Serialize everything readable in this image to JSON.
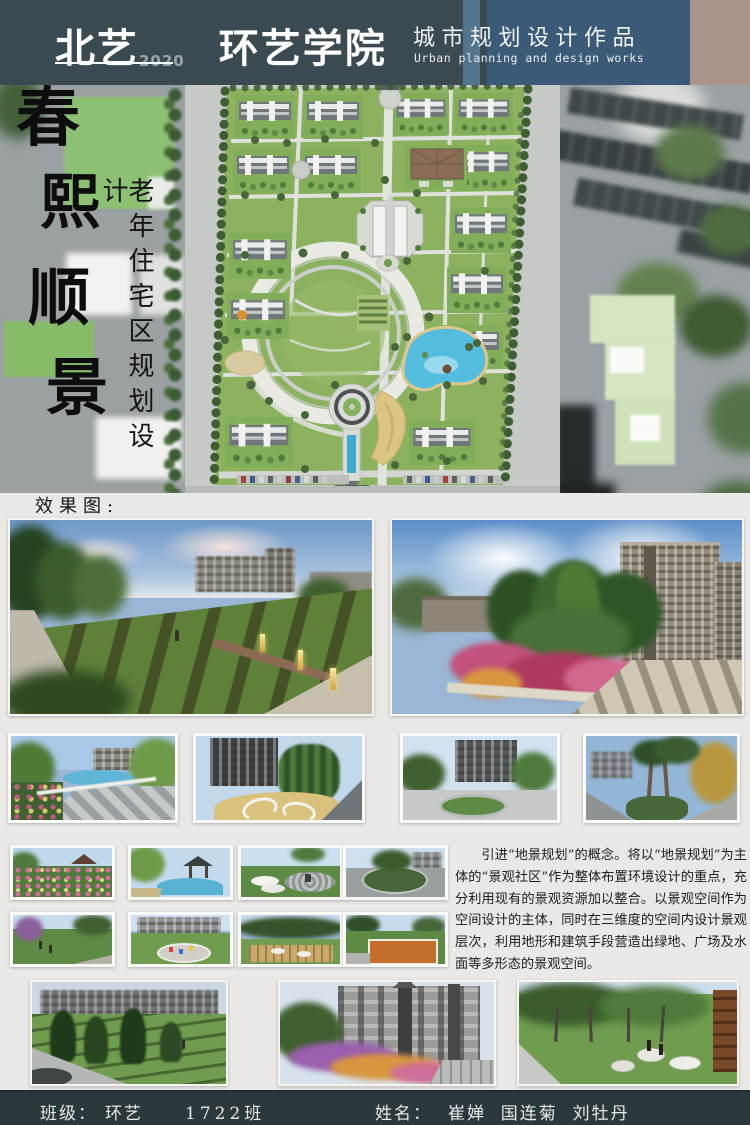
{
  "header": {
    "brand": "北艺",
    "brand_year": "2020",
    "college": "环艺学院",
    "work_title_cn": "城市规划设计作品",
    "work_title_en": "Urban planning and design works"
  },
  "hero": {
    "calligraphy": [
      "春",
      "熙",
      "顺",
      "景"
    ],
    "project_title_vertical": "老年住宅区规划设计"
  },
  "body": {
    "renders_label": "效果图:",
    "description": "引进“地景规划”的概念。将以“地景规划”为主体的“景观社区”作为整体布置环境设计的重点，充分利用现有的景观资源加以整合。以景观空间作为空间设计的主体，同时在三维度的空间内设计景观层次，利用地形和建筑手段营造出绿地、广场及水面等多形态的景观空间。"
  },
  "footer": {
    "class_label": "班级：",
    "class_name": "环艺",
    "class_number": "1722班",
    "name_label": "姓名：",
    "student_names": "崔婵  国连菊  刘牡丹"
  },
  "colors": {
    "header_dark": "#3b4950",
    "header_blue": "#3a5a78",
    "header_tan": "#a8948a",
    "footer_dark": "#2c393c",
    "page_bg": "#eae9e6",
    "lawn_green": "#8cb25f",
    "water_blue": "#54bddd"
  }
}
